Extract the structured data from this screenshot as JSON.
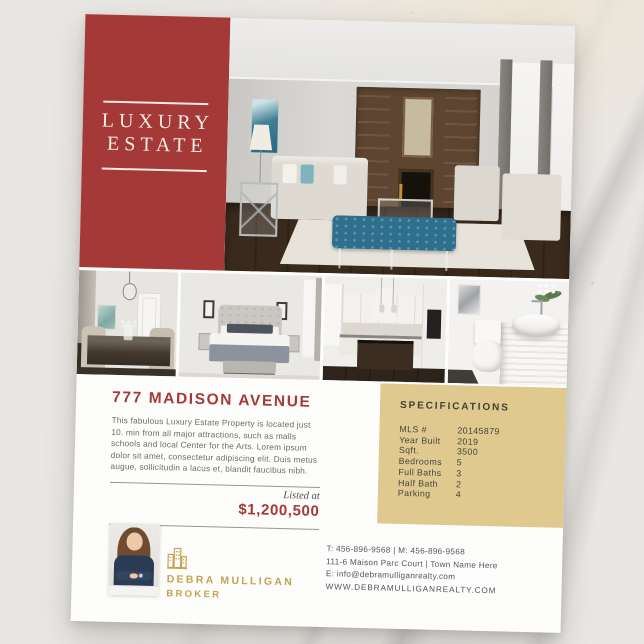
{
  "flyer": {
    "brand": {
      "line1": "LUXURY",
      "line2": "ESTATE"
    },
    "listing": {
      "title": "777 MADISON AVENUE",
      "description": "This fabulous Luxury Estate Property is located just 10. min from all major attractions, such as malls schools and local Center for the Arts. Lorem ipsum dolor sit amet, consectetur adipiscing elit. Duis metus augue, sollicitudin a lacus et, blandit faucibus nibh.",
      "listed_at_label": "Listed at",
      "price": "$1,200,500"
    },
    "specifications": {
      "heading": "SPECIFICATIONS",
      "rows": [
        {
          "label": "MLS #",
          "value": "20145879"
        },
        {
          "label": "Year Built",
          "value": "2019"
        },
        {
          "label": "Sqft.",
          "value": "3500"
        },
        {
          "label": "Bedrooms",
          "value": "5"
        },
        {
          "label": "Full Baths",
          "value": "3"
        },
        {
          "label": "Half Bath",
          "value": "2"
        },
        {
          "label": "Parking",
          "value": "4"
        }
      ]
    },
    "agent": {
      "name": "DEBRA MULLIGAN",
      "role": "BROKER"
    },
    "contact": {
      "phones": "T: 456-896-9568 | M: 456-896-9568",
      "address": "111-6 Maison Parc Court | Town Name Here",
      "email": "E: info@debramulliganrealty.com",
      "website": "WWW.DEBRAMULLIGANREALTY.COM"
    },
    "colors": {
      "brand_red": "#A43937",
      "gold_panel": "#DFC98E",
      "gold_accent": "#C4A350"
    },
    "photos": [
      "living-room",
      "dining-room",
      "bedroom",
      "kitchen",
      "bathroom",
      "agent-headshot"
    ]
  }
}
